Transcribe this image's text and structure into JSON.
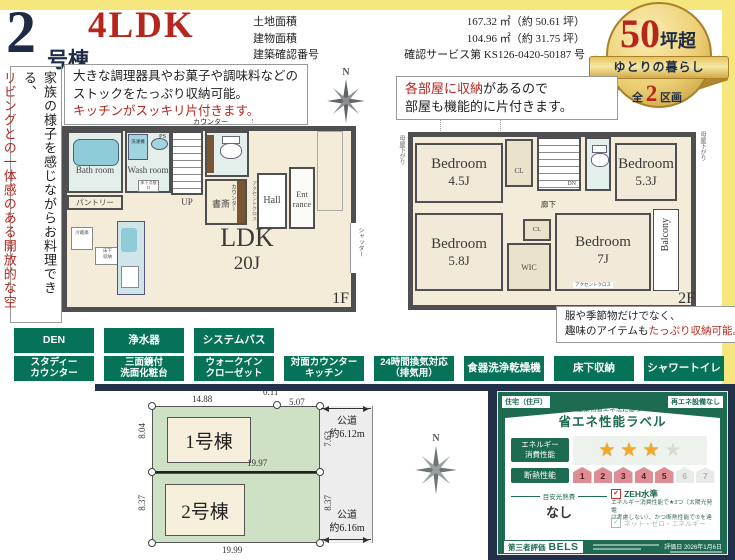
{
  "header": {
    "building_no": "2",
    "building_suffix": "号棟",
    "layout_type": "4LDK",
    "area_rows": [
      {
        "label": "土地面積",
        "value": "167.32 ㎡（約 50.61 坪）"
      },
      {
        "label": "建物面積",
        "value": "104.96 ㎡（約 31.75 坪）"
      },
      {
        "label": "建築確認番号",
        "value": "確認サービス第 KS126-0420-50187 号"
      }
    ]
  },
  "medal": {
    "num": "50",
    "num_suffix": "坪超",
    "ribbon": "ゆとりの暮らし",
    "bottom_prefix": "全",
    "bottom_num": "2",
    "bottom_suffix": "区画"
  },
  "side_note": {
    "black_line": "家族の様子を感じながらお料理できる、",
    "red_line": "リビングとの一体感のある開放的な空間。"
  },
  "callout_kitchen": {
    "line1": "大きな調理器具やお菓子や調味料などの",
    "line2": "ストックをたっぷり収納可能。",
    "line3": "キッチンがスッキリ片付きます。"
  },
  "callout_rooms": {
    "red": "各部屋に収納",
    "black": "があるので",
    "line2": "部屋も機能的に片付きます。"
  },
  "callout_storage": {
    "line1": "服や季節物だけでなく、",
    "line2_black": "趣味のアイテムも",
    "line2_red": "たっぷり収納可能。"
  },
  "compass": {
    "label": "N"
  },
  "floor1": {
    "floor_label": "1F",
    "labels": {
      "ps": "PS",
      "counter_top": "カウンター",
      "washer": "洗濯機",
      "bath": "Bath room",
      "wash": "Wash room",
      "hatch": "床下点検口",
      "pantry": "パントリー",
      "up": "UP",
      "study": "書斎",
      "counter_v": "カウンター",
      "accent": "アクセントクロス",
      "hall": "Hall",
      "entrance_1": "Ent",
      "entrance_2": "rance",
      "ldk": "LDK",
      "ldk_size": "20J",
      "fridge": "冷蔵庫",
      "floor_storage_1": "床下",
      "floor_storage_2": "収納",
      "shutter": "シャッター"
    }
  },
  "floor2": {
    "floor_label": "2F",
    "labels": {
      "eaves_left": "母屋下がり",
      "eaves_right": "母屋下がり",
      "bedroom1": "Bedroom",
      "bedroom1_size": "4.5J",
      "cl1": "CL",
      "dn": "DN",
      "bedroom2": "Bedroom",
      "bedroom2_size": "5.3J",
      "hallway": "廊下",
      "cl2": "CL",
      "bedroom3": "Bedroom",
      "bedroom3_size": "5.8J",
      "wic": "WIC",
      "bedroom4": "Bedroom",
      "bedroom4_size": "7J",
      "accent": "アクセントクロス",
      "balcony": "Balcony"
    }
  },
  "features": {
    "row1": [
      [
        "DEN"
      ],
      [
        "浄水器"
      ],
      [
        "システムバス"
      ]
    ],
    "row2": [
      [
        "スタディー",
        "カウンター"
      ],
      [
        "三面鏡付",
        "洗面化粧台"
      ],
      [
        "ウォークイン",
        "クローゼット"
      ],
      [
        "対面カウンター",
        "キッチン"
      ],
      [
        "24時間換気対応",
        "（排気用）"
      ],
      [
        "食器洗浄乾燥機"
      ],
      [
        "床下収納"
      ],
      [
        "シャワートイレ"
      ]
    ]
  },
  "site_plan": {
    "lot1_name": "1号棟",
    "lot2_name": "2号棟",
    "dims": {
      "lot1_top": "14.88",
      "jog": "0.11",
      "lot1_top2": "5.07",
      "lot1_left": "8.04",
      "lot1_right": "7.63",
      "lot1_bottom": "19.97",
      "lot2_left": "8.37",
      "lot2_right": "8.37",
      "lot2_bottom": "19.99"
    },
    "road_top": [
      "公道",
      "約6.12m"
    ],
    "road_bottom": [
      "公道",
      "約6.16m"
    ]
  },
  "energy_label": {
    "chip_left": "住宅（住戸）",
    "chip_right": "再エネ設備なし",
    "subtitle": "建築物省エネ法に基づく",
    "title": "省エネ性能ラベル",
    "energy_row_label": [
      "エネルギー",
      "消費性能"
    ],
    "stars_filled": 3,
    "stars_total": 4,
    "insulation_label": "断熱性能",
    "insulation_levels": [
      "1",
      "2",
      "3",
      "4",
      "5",
      "6",
      "7"
    ],
    "insulation_achieved": 5,
    "cost_label": "目安光熱費",
    "cost_value": "なし",
    "zeh_check": "✔",
    "zeh_label": "ZEH水準",
    "zeh_desc1": "エネルギー消費性能で★3つ（太陽光発電",
    "zeh_desc2": "は考慮しない）、かつ断熱性能で⑤を達成",
    "net_zero_check": "✓",
    "net_zero_label": "ネット・ゼロ・エネルギー",
    "cert_label": "第三者評価",
    "cert_name": "BELS",
    "eval_date": "評価日 2026年1月6日"
  },
  "colors": {
    "accent_red": "#b7261d",
    "navy": "#22304a",
    "feature_green": "#067257",
    "medal_gold": "#d9b554",
    "label_green": "#1d6b50",
    "site_green": "#cfe1c5",
    "yellow": "#f5e67e"
  }
}
